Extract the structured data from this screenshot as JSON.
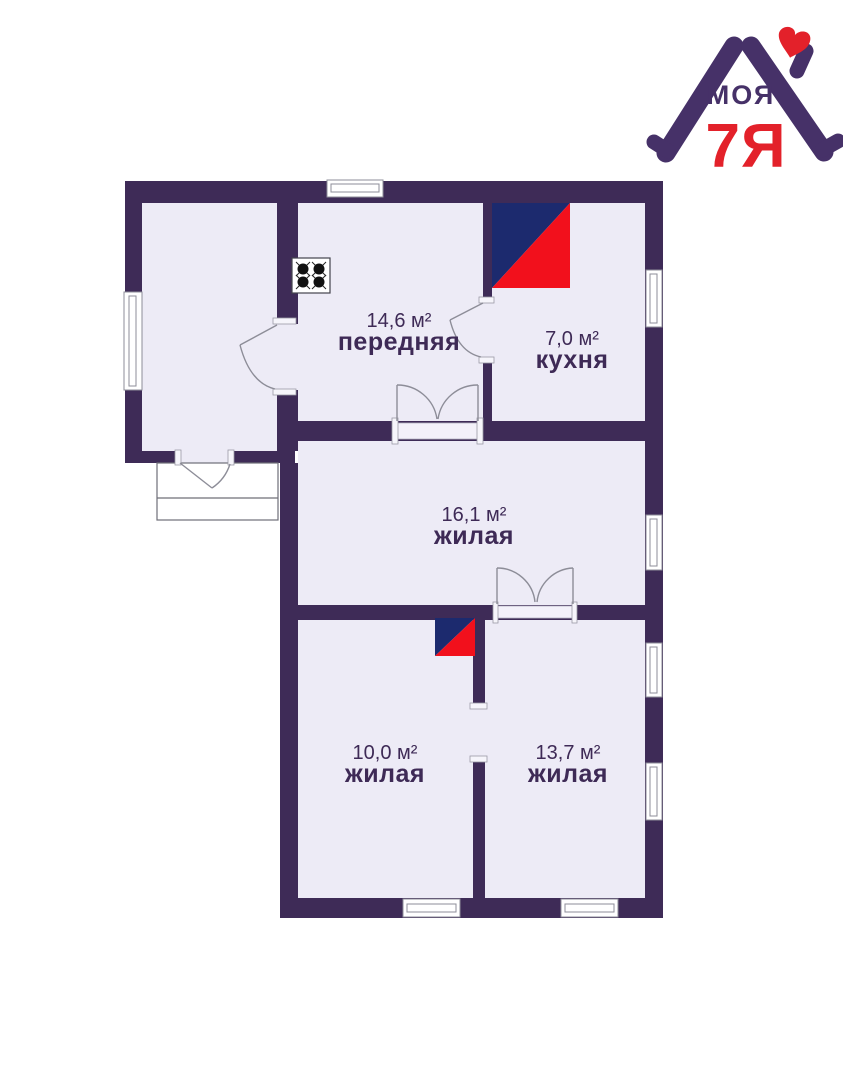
{
  "logo": {
    "text_top": "МОЯ",
    "text_bottom": "7Я",
    "colors": {
      "purple": "#463168",
      "red": "#e3212a"
    }
  },
  "floorplan": {
    "colors": {
      "wall": "#3e2b57",
      "room_fill": "#edebf6",
      "stove_blue": "#1c2a6e",
      "stove_red": "#f2101c",
      "label_text": "#3e2a56"
    },
    "icons": {
      "gas-stove-icon": "square with 4 black burners",
      "furnace-icon": "square split diagonally blue/red",
      "heart-icon": "red heart in logo"
    },
    "rooms": [
      {
        "key": "hallway",
        "area_label": "14,6 м²",
        "name_label": "передняя"
      },
      {
        "key": "kitchen",
        "area_label": "7,0 м²",
        "name_label": "кухня"
      },
      {
        "key": "living-large",
        "area_label": "16,1 м²",
        "name_label": "жилая"
      },
      {
        "key": "living-small",
        "area_label": "10,0 м²",
        "name_label": "жилая"
      },
      {
        "key": "living-medium",
        "area_label": "13,7 м²",
        "name_label": "жилая"
      }
    ]
  }
}
